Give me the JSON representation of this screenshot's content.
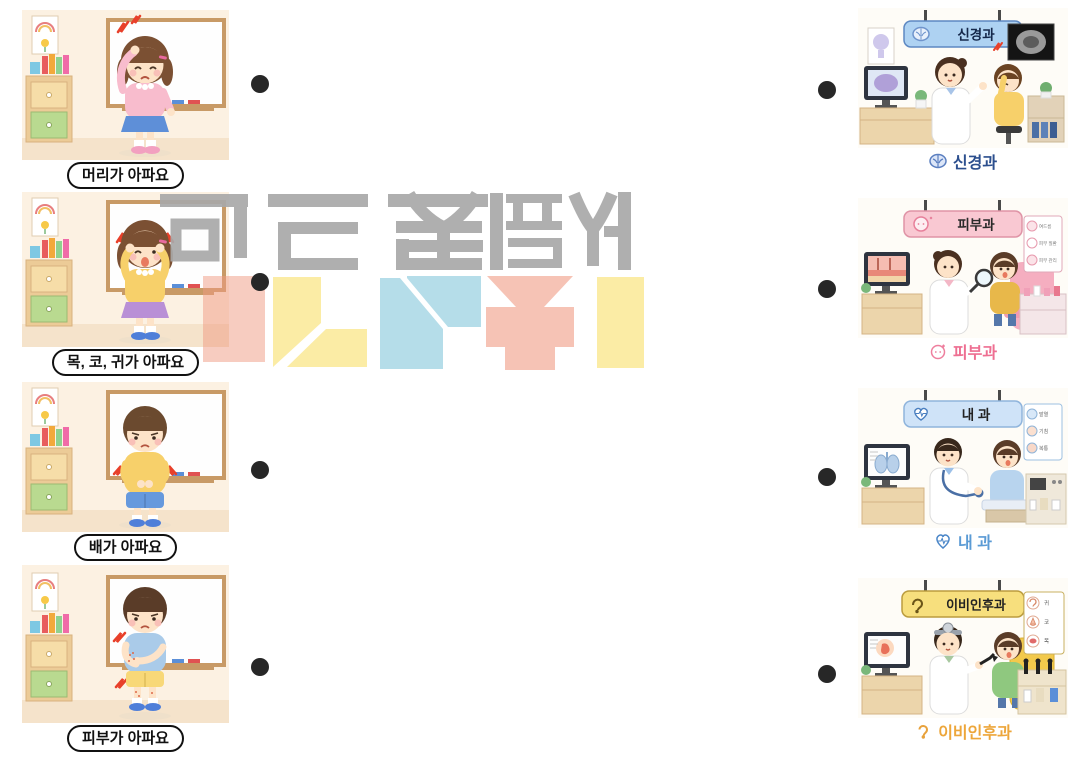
{
  "worksheet": {
    "left_items": [
      {
        "label": "머리가 아파요",
        "scene": "girl-holding-head-in-classroom"
      },
      {
        "label": "목, 코, 귀가 아파요",
        "scene": "girl-touching-ears-in-classroom"
      },
      {
        "label": "배가 아파요",
        "scene": "boy-holding-stomach-in-classroom"
      },
      {
        "label": "피부가 아파요",
        "scene": "boy-scratching-arm-in-classroom"
      }
    ],
    "right_items": [
      {
        "sign": "신경과",
        "caption": "신경과",
        "icon": "brain-icon",
        "sign_bg": "#aed2f2",
        "sign_border": "#5d88c2",
        "sign_text_color": "#15284b",
        "caption_color": "#2c4f8e",
        "chart": []
      },
      {
        "sign": "피부과",
        "caption": "피부과",
        "icon": "face-icon",
        "sign_bg": "#f9c8d2",
        "sign_border": "#df93a6",
        "sign_text_color": "#2a2a2a",
        "caption_color": "#ee6f92",
        "chart": [
          "여드름",
          "피부 질환",
          "피부 관리"
        ]
      },
      {
        "sign": "내 과",
        "caption": "내 과",
        "icon": "heart-ekg-icon",
        "sign_bg": "#cfe3f8",
        "sign_border": "#8fb4dc",
        "sign_text_color": "#222222",
        "caption_color": "#5b9bd5",
        "chart": [
          "발열",
          "기침",
          "복통"
        ]
      },
      {
        "sign": "이비인후과",
        "caption": "이비인후과",
        "icon": "ear-icon",
        "sign_bg": "#f7df7d",
        "sign_border": "#bb9c3e",
        "sign_text_color": "#222222",
        "caption_color": "#eda63a",
        "chart": [
          "귀",
          "코",
          "목"
        ]
      }
    ],
    "match_dots": {
      "left_count": 4,
      "right_count": 4,
      "color": "#272727"
    }
  },
  "watermark": {
    "text": "마드는 쥐픔사",
    "orientation": "flipped-hangul",
    "text_color": "#a9a9a9",
    "block_colors": [
      "#ef9a82",
      "#fbeca5",
      "#b5dde9",
      "#f6c3b5"
    ]
  }
}
